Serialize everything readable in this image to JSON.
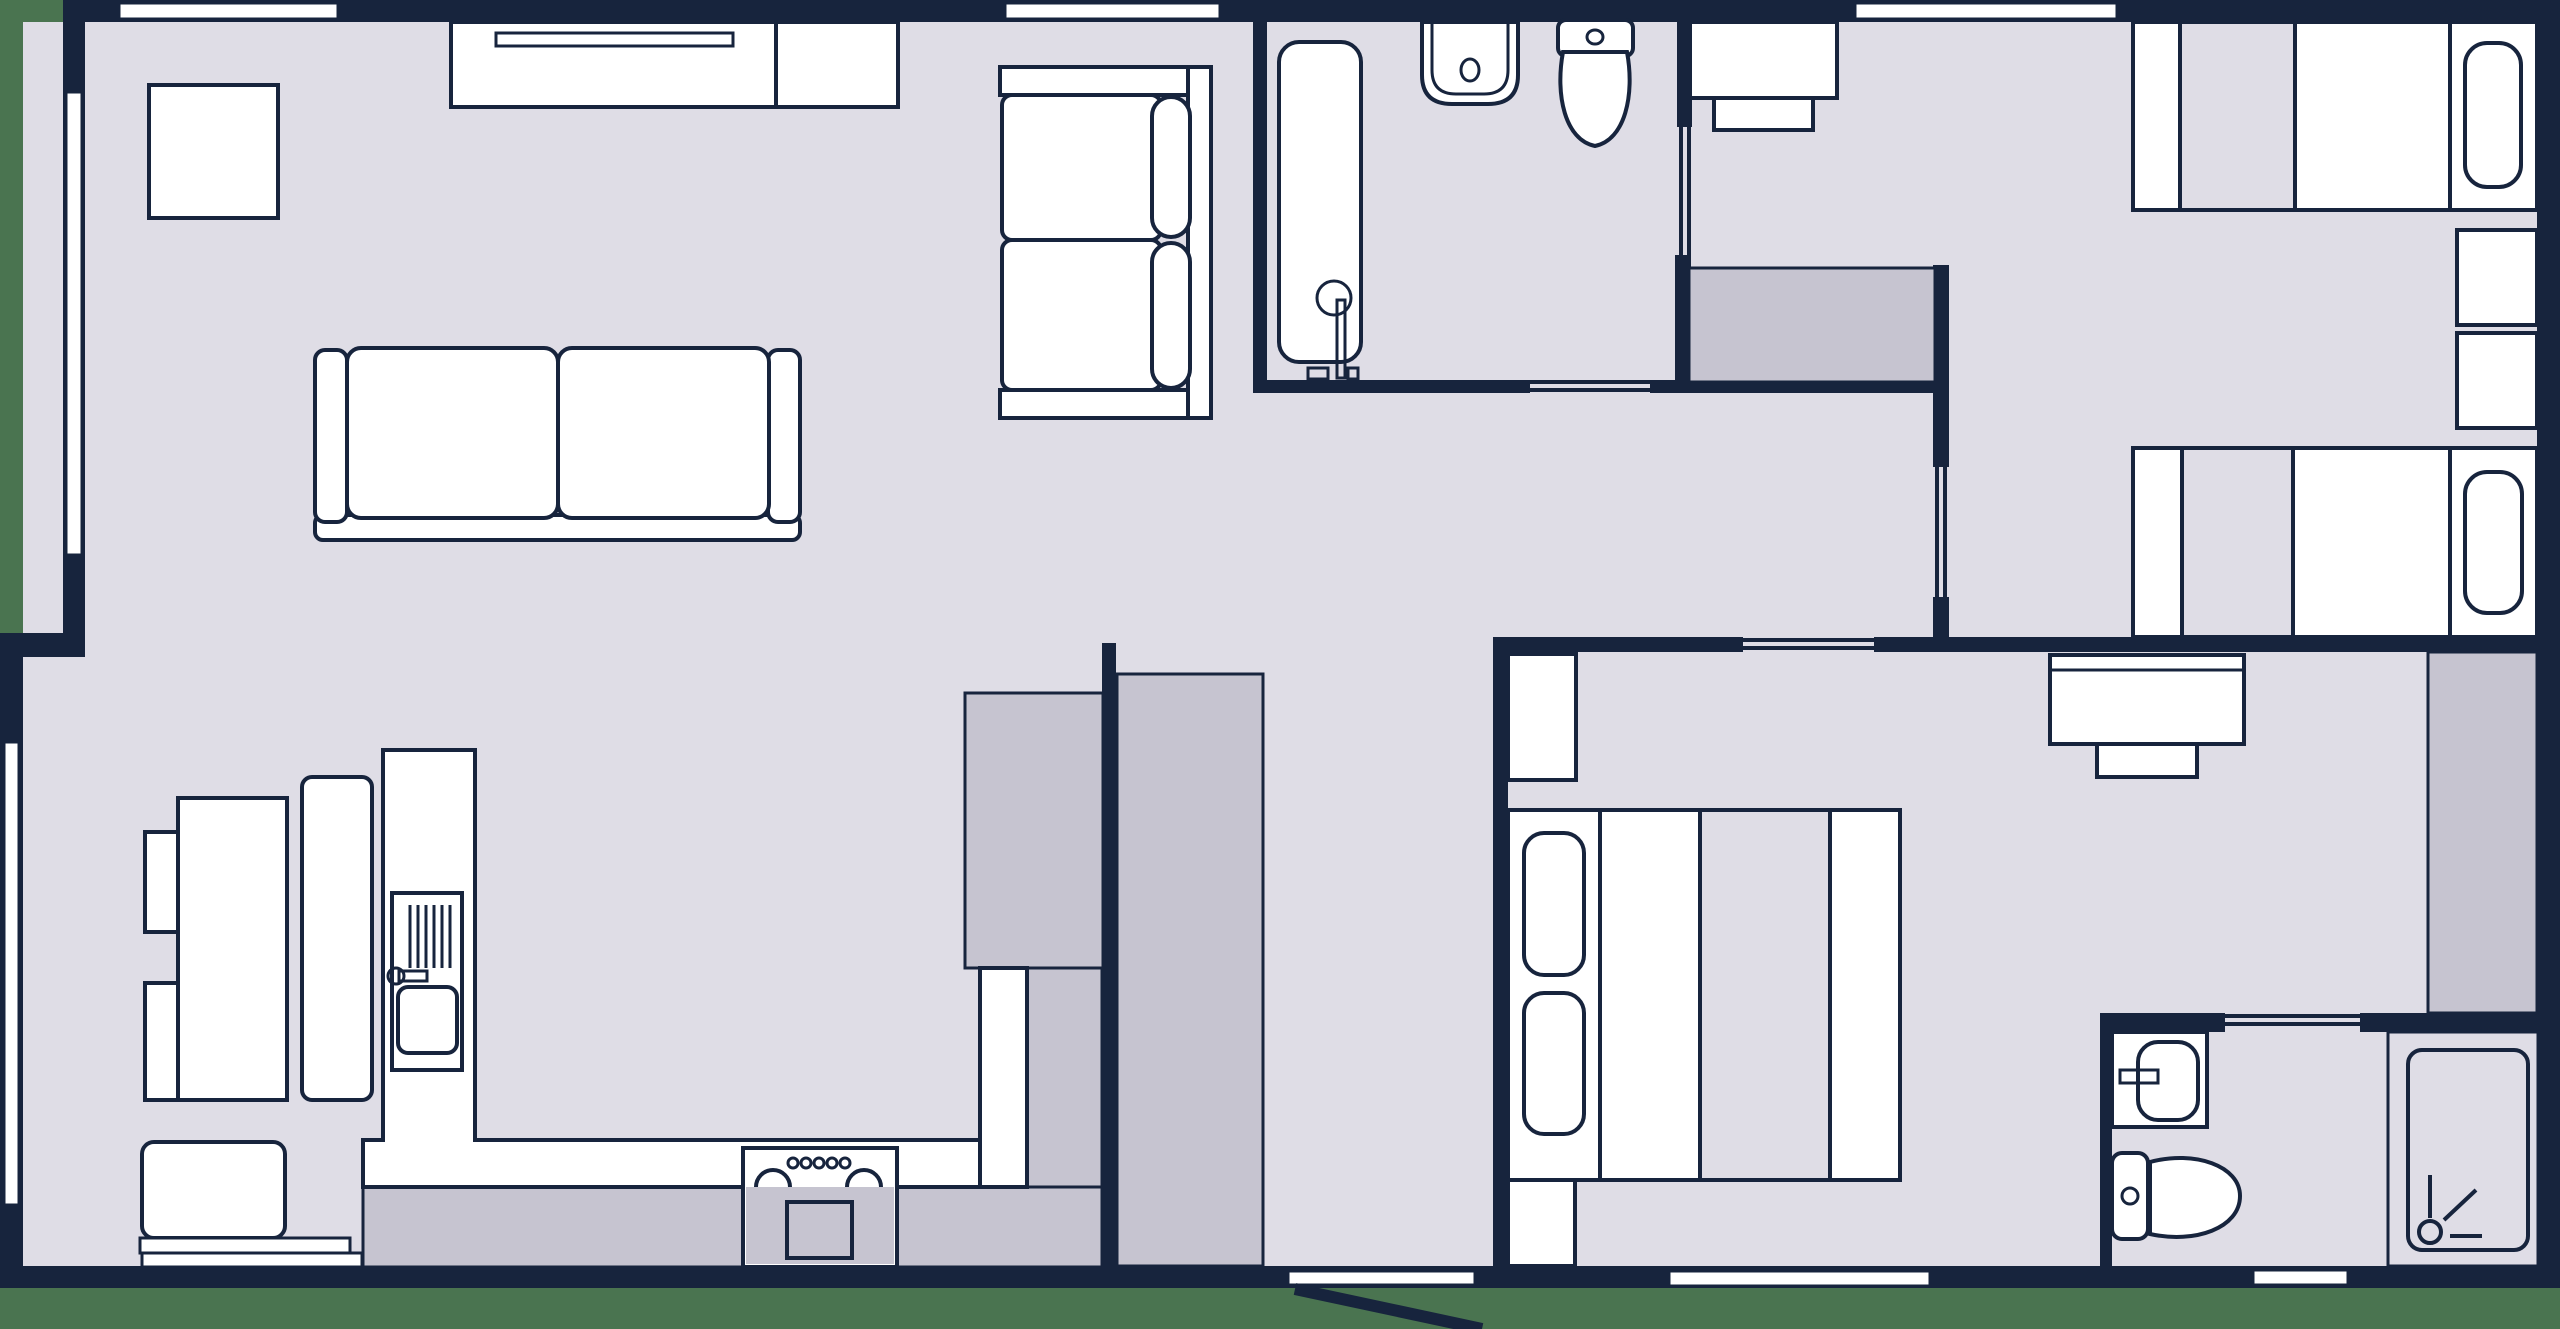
{
  "meta": {
    "type": "floor-plan",
    "canvas": {
      "width": 2560,
      "height": 1329
    },
    "style": "2d-top-down-architectural"
  },
  "palette": {
    "background_green": "#4a7450",
    "wall_navy": "#17243d",
    "floor_light": "#dfdde6",
    "shade_gray": "#c6c4d0",
    "fixture_white": "#ffffff"
  },
  "legend": {
    "rooms": [
      {
        "id": "living-room",
        "area": "top-left"
      },
      {
        "id": "kitchen-dining",
        "area": "bottom-left"
      },
      {
        "id": "bathroom-main",
        "area": "top-middle"
      },
      {
        "id": "bedroom-twin",
        "area": "top-right"
      },
      {
        "id": "hallway",
        "area": "middle-right"
      },
      {
        "id": "bedroom-double",
        "area": "bottom-middle-right"
      },
      {
        "id": "bathroom-ensuite",
        "area": "bottom-right"
      },
      {
        "id": "entry-corridor",
        "area": "bottom-middle"
      }
    ],
    "fixtures": [
      "tv-sideboard",
      "armchair-square",
      "sofa-three-seat",
      "loveseat-two-seat",
      "dining-table",
      "dining-chair",
      "dining-chair",
      "dining-bench",
      "kitchen-island",
      "kitchen-counter",
      "kitchen-sink",
      "stove-oven",
      "tall-cabinet",
      "wardrobe-closet",
      "wardrobe-closet",
      "wardrobe-closet",
      "bathtub",
      "wash-basin",
      "toilet",
      "desk",
      "desk-chair",
      "single-bed",
      "single-bed",
      "nightstand",
      "nightstand",
      "double-bed",
      "nightstand",
      "foot-cabinet",
      "desk",
      "desk-chair",
      "wash-basin",
      "toilet",
      "shower-enclosure"
    ],
    "openings": {
      "windows": 7,
      "sliding_doors": 5,
      "hinged_doors": 1
    }
  }
}
